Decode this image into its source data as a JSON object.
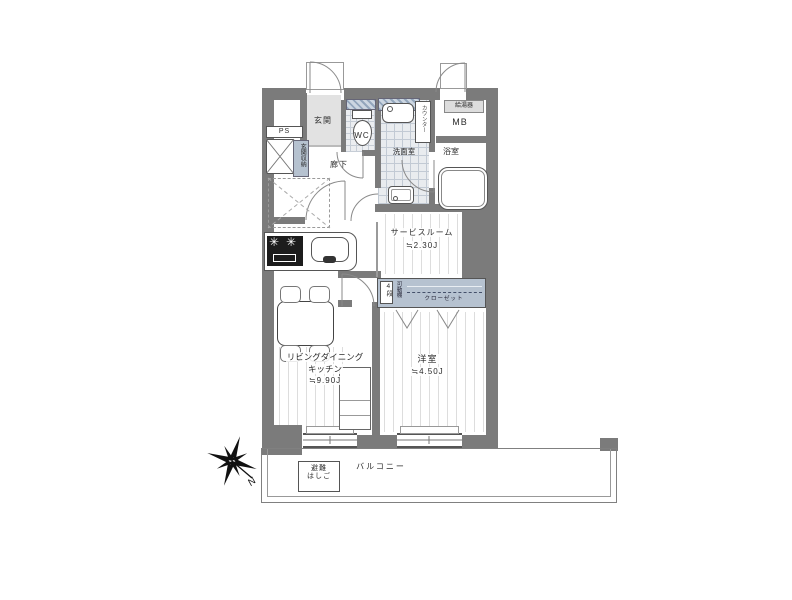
{
  "plan": {
    "rooms": {
      "genkan": {
        "label": "玄関"
      },
      "hallway": {
        "label": "廊下"
      },
      "wc": {
        "label": "WC"
      },
      "washroom": {
        "label": "洗面室"
      },
      "bathroom": {
        "label": "浴室"
      },
      "service_room": {
        "label": "サービスルーム",
        "size": "≒2.30J"
      },
      "western_room": {
        "label": "洋室",
        "size": "≒4.50J"
      },
      "ldk": {
        "label_line1": "リビングダイニング",
        "label_line2": "キッチン",
        "size": "≒9.90J"
      },
      "balcony": {
        "label": "バルコニー"
      }
    },
    "fixtures": {
      "ps": "PS",
      "genkan_storage": "玄関収納",
      "counter": "カウンター",
      "meter_box": "MB",
      "water_heater": "給湯器",
      "closet": "クローゼット",
      "shelf_tiers": "4段",
      "movable_shelf": "可動棚",
      "evac_line1": "避難",
      "evac_line2": "はしご"
    },
    "compass": {
      "north": "N"
    },
    "colors": {
      "wall": "#7b7b7b",
      "fixture_blue": "#b6c2d0",
      "outline": "#555555",
      "floor_line": "#d7d7d7"
    }
  }
}
